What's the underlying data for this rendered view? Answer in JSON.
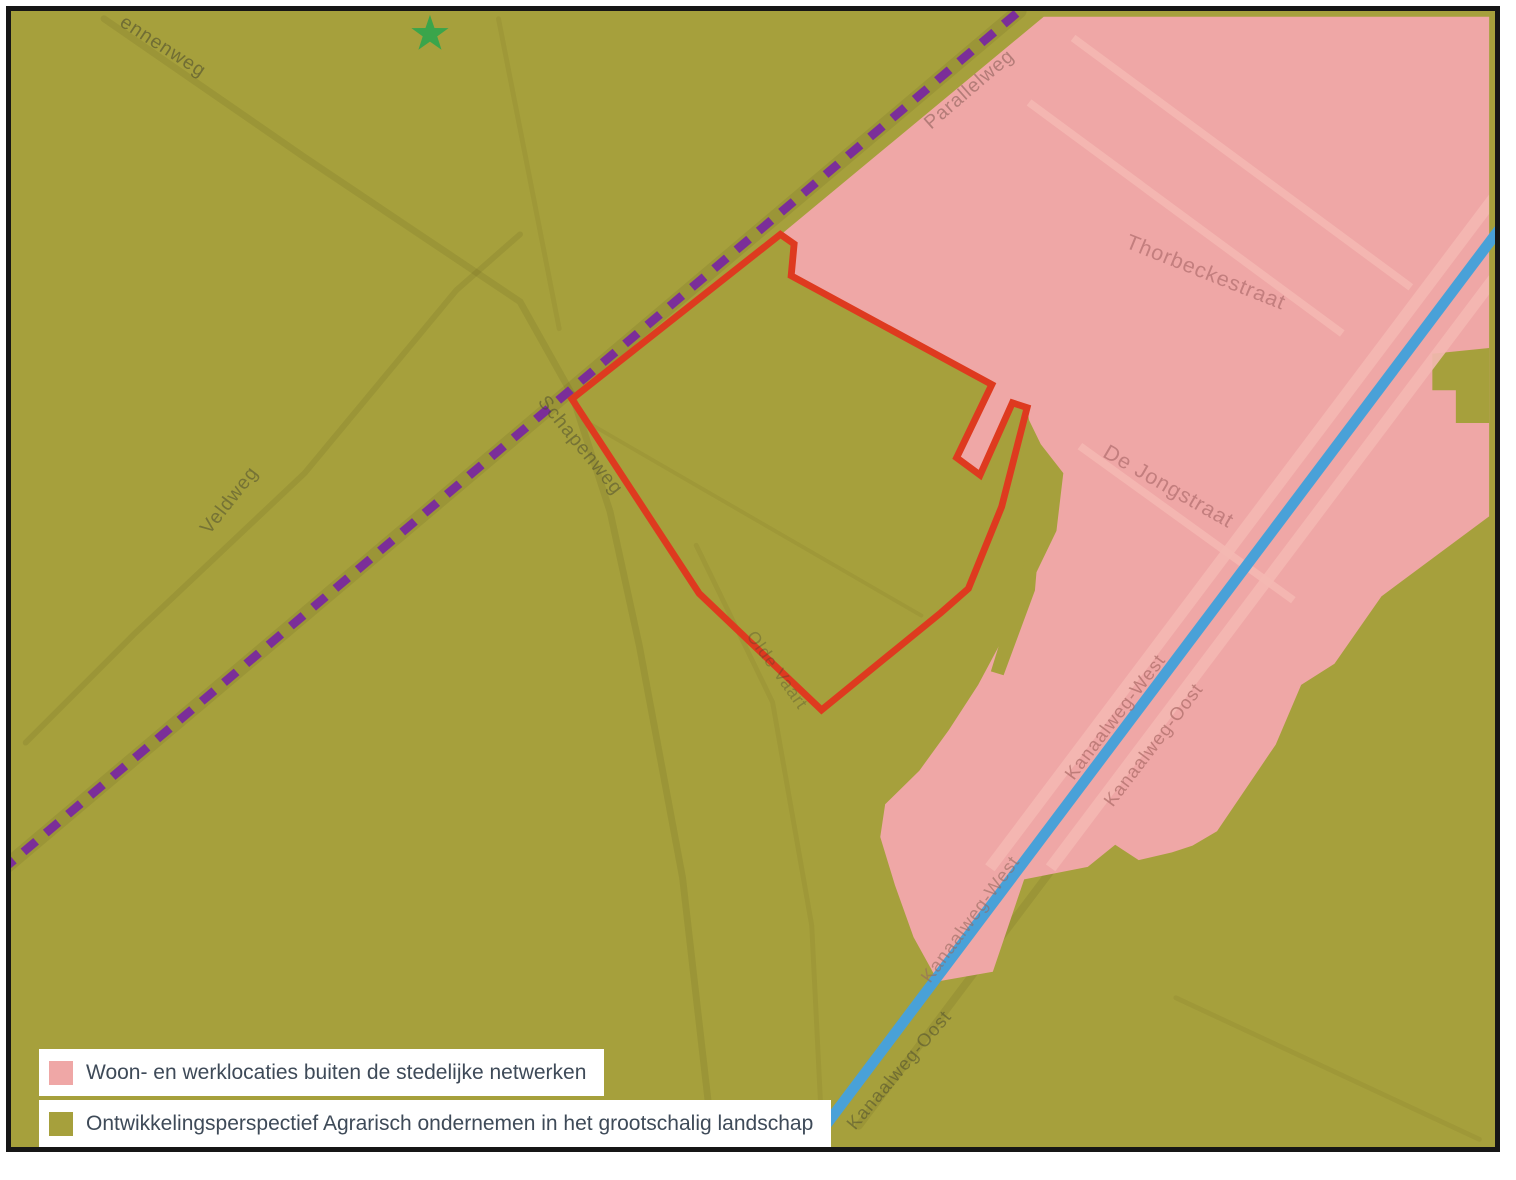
{
  "map": {
    "labels": [
      {
        "text": "ennenweg"
      },
      {
        "text": "Parallelweg"
      },
      {
        "text": "Thorbeckestraat"
      },
      {
        "text": "De Jongstraat"
      },
      {
        "text": "Veldweg"
      },
      {
        "text": "Schapenweg"
      },
      {
        "text": "Kanaalweg-West"
      },
      {
        "text": "Kanaalweg-Oost"
      },
      {
        "text": "Kanaalweg-West"
      },
      {
        "text": "Kanaalweg-Oost"
      },
      {
        "text": "Olde Vaart"
      }
    ]
  },
  "legend": {
    "items": [
      {
        "label": "Woon- en werklocaties buiten de stedelijke netwerken",
        "color": "#efa7a6"
      },
      {
        "label": "Ontwikkelingsperspectief Agrarisch ondernemen in het grootschalig landschap",
        "color": "#a6a03c"
      }
    ]
  },
  "colors": {
    "olive": "#a6a03c",
    "pink": "#efa7a6",
    "canal_blue": "#49a1d8",
    "boundary_red": "#de3a1f",
    "route_purple": "#7b2e99",
    "star_green": "#3aa54b",
    "legend_text": "#3e4a58"
  }
}
